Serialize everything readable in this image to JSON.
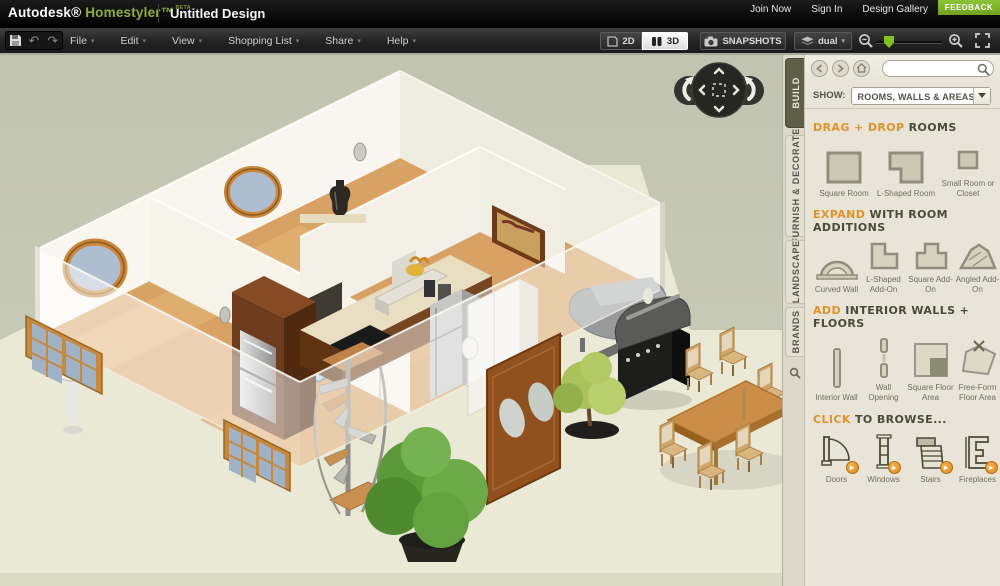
{
  "header": {
    "autodesk": "Autodesk®",
    "homestyler": "Homestyler™",
    "beta": "BETA",
    "doc_title": "Untitled Design",
    "links": [
      "Join Now",
      "Sign In",
      "Design Gallery"
    ],
    "feedback": "FEEDBACK"
  },
  "toolbar": {
    "menus": [
      "File",
      "Edit",
      "View",
      "Shopping List",
      "Share",
      "Help"
    ],
    "view_2d": "2D",
    "view_3d": "3D",
    "snapshots": "SNAPSHOTS",
    "dual": "dual"
  },
  "sidebar": {
    "tabs": [
      {
        "label": "BUILD",
        "active": true
      },
      {
        "label": "FURNISH & DECORATE",
        "active": false
      },
      {
        "label": "LANDSCAPE",
        "active": false
      },
      {
        "label": "BRANDS",
        "active": false
      }
    ],
    "search_value": "",
    "show_label": "SHOW:",
    "show_value": "ROOMS, WALLS & AREAS",
    "sections": [
      {
        "accent": "DRAG + DROP",
        "rest": "ROOMS",
        "items": [
          {
            "label": "Square Room",
            "icon": "square-room-icon"
          },
          {
            "label": "L-Shaped Room",
            "icon": "l-shaped-room-icon"
          },
          {
            "label": "Small Room or Closet",
            "icon": "small-room-icon"
          }
        ]
      },
      {
        "accent": "EXPAND",
        "rest": "WITH ROOM ADDITIONS",
        "items": [
          {
            "label": "Curved Wall",
            "icon": "curved-wall-icon"
          },
          {
            "label": "L-Shaped Add-On",
            "icon": "l-shaped-addon-icon"
          },
          {
            "label": "Square Add-On",
            "icon": "square-addon-icon"
          },
          {
            "label": "Angled Add-On",
            "icon": "angled-addon-icon"
          }
        ]
      },
      {
        "accent": "ADD",
        "rest": "INTERIOR WALLS + FLOORS",
        "items": [
          {
            "label": "Interior Wall",
            "icon": "interior-wall-icon"
          },
          {
            "label": "Wall Opening",
            "icon": "wall-opening-icon"
          },
          {
            "label": "Square Floor Area",
            "icon": "square-floor-area-icon"
          },
          {
            "label": "Free-Form Floor Area",
            "icon": "free-form-floor-area-icon"
          }
        ]
      },
      {
        "accent": "CLICK",
        "rest": "TO BROWSE...",
        "items": [
          {
            "label": "Doors",
            "icon": "doors-icon"
          },
          {
            "label": "Windows",
            "icon": "windows-icon"
          },
          {
            "label": "Stairs",
            "icon": "stairs-icon"
          },
          {
            "label": "Fireplaces",
            "icon": "fireplaces-icon"
          }
        ]
      }
    ]
  },
  "colors": {
    "accent_orange": "#e0922a",
    "brand_green": "#8fae3a",
    "feedback_green": "#7cb22a",
    "canvas_olive": "#c4c7b3",
    "ground_cream": "#eae9d5",
    "sidebar_beige": "#e8e5d8"
  }
}
